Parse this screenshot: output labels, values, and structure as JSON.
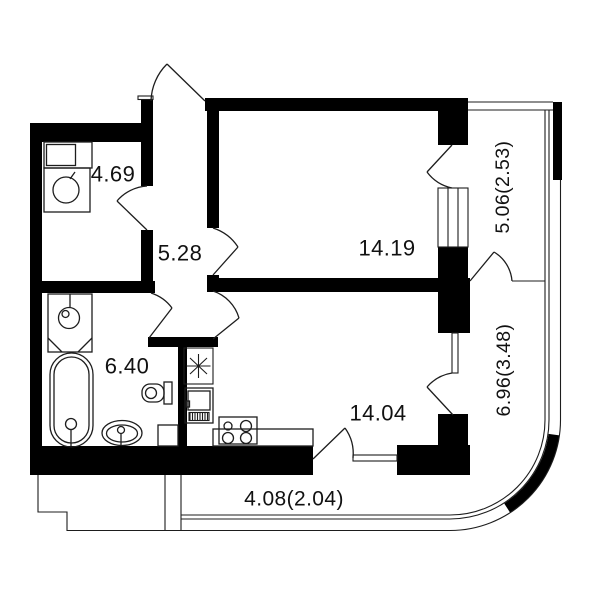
{
  "page": {
    "title": "Apartment floor plan",
    "background": "#ffffff"
  },
  "colors": {
    "wall": "#000000",
    "line": "#1d1d1d",
    "text": "#111111",
    "background": "#ffffff"
  },
  "rooms": [
    {
      "name": "storage-room",
      "area_label": "4.69"
    },
    {
      "name": "hallway",
      "area_label": "5.28"
    },
    {
      "name": "bedroom",
      "area_label": "14.19"
    },
    {
      "name": "bathroom",
      "area_label": "6.40"
    },
    {
      "name": "kitchen-living-room",
      "area_label": "14.04"
    },
    {
      "name": "balcony-right-upper",
      "area_label": "5.06(2.53)"
    },
    {
      "name": "balcony-right-lower",
      "area_label": "6.96(3.48)"
    },
    {
      "name": "balcony-bottom",
      "area_label": "4.08(2.04)"
    }
  ],
  "fixtures": [
    "cabinet-icon",
    "washing-machine-icon",
    "shower-cabin-icon",
    "bathtub-icon",
    "washbasin-icon",
    "toilet-icon",
    "laundry-unit-icon",
    "vent-shaft-star-icon",
    "refrigerator-icon",
    "kitchen-counter-icon",
    "stove-icon"
  ]
}
